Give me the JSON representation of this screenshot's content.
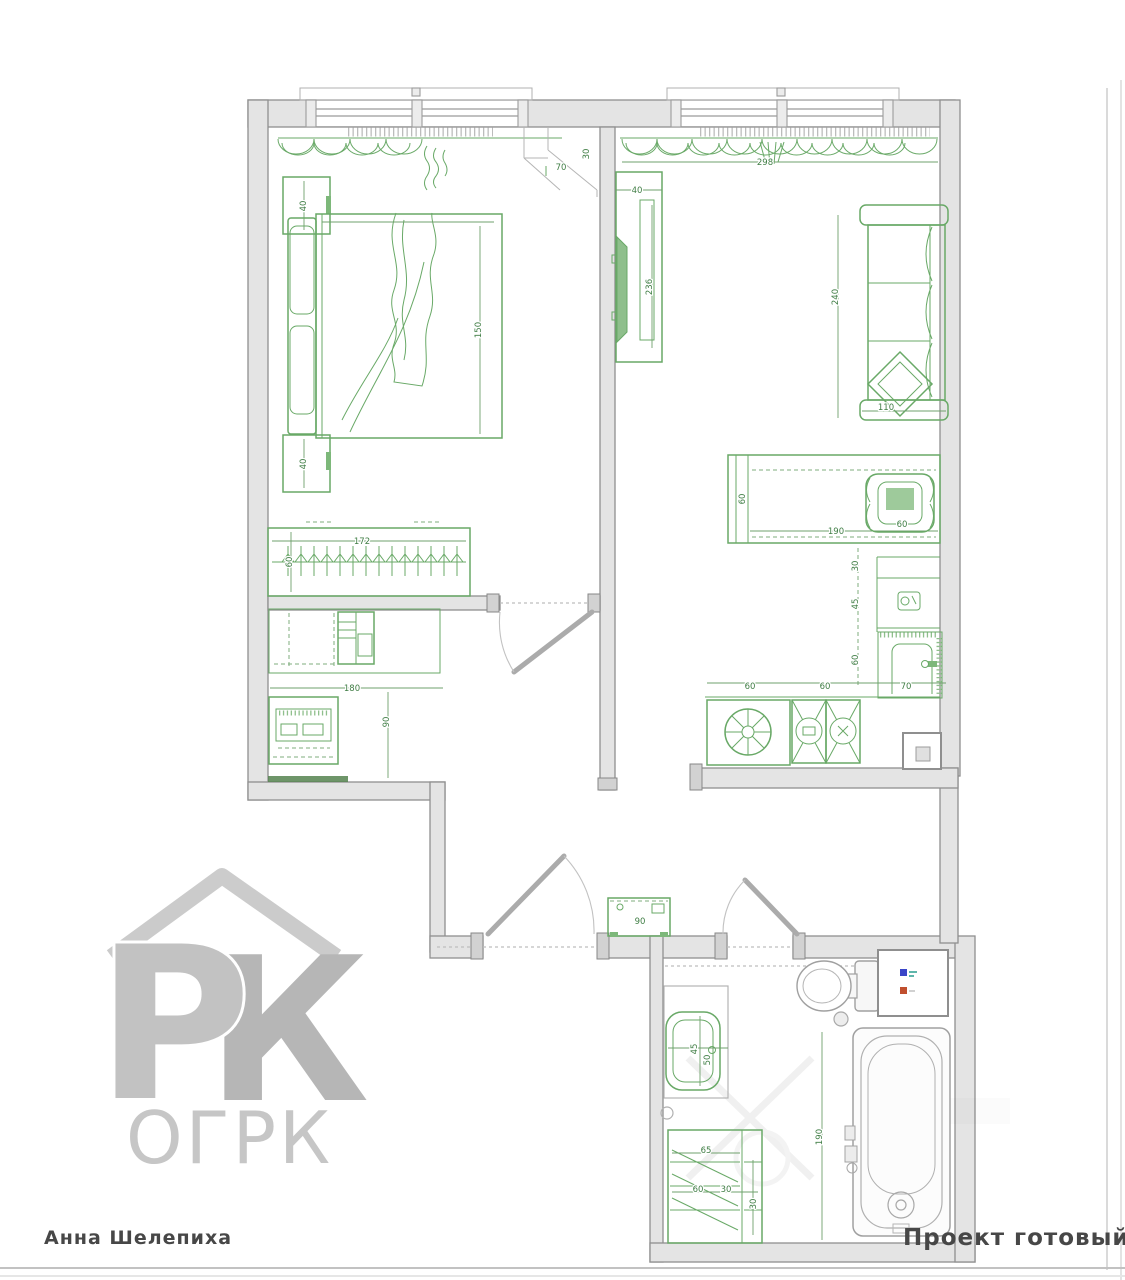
{
  "captions": {
    "author": "Анна Шелепиха",
    "status": "Проект готовый"
  },
  "watermark": {
    "letter_p": "Р",
    "letter_k": "К",
    "org": "ОГРК"
  },
  "colors": {
    "furniture_green": "#69a967",
    "dim_text_green": "#3f7d44",
    "wall_fill": "#e4e4e4",
    "wall_stroke": "#8f8f8f",
    "watermark_gray": "#c4c4c4",
    "caption_gray": "#474747",
    "cold_water_blue": "#3a46c8",
    "hot_water_red": "#c04f2e"
  },
  "dims": {
    "bedroom_nightstand_top": "40",
    "bedroom_corner_w": "70",
    "bedroom_corner_d": "30",
    "bed_length": "150",
    "wardrobe_width": "172",
    "wardrobe_depth": "60",
    "bedroom_nightstand_bottom": "40",
    "hall_width": "180",
    "hall_depth": "90",
    "living_width": "298",
    "tv_unit_depth": "40",
    "tv_unit_length": "236",
    "sofa_length": "240",
    "sofa_width": "110",
    "desk_depth": "60",
    "desk_length": "190",
    "chair_size": "60",
    "kitchen_side_1": "30",
    "kitchen_side_2": "45",
    "kitchen_side_3": "60",
    "kitchen_row_1": "60",
    "kitchen_row_2": "60",
    "kitchen_row_3": "70",
    "shoe_cabinet_width": "90",
    "sink_w": "45",
    "sink_d": "50",
    "bath_unit_top": "65",
    "bath_unit_a": "60",
    "bath_unit_b": "30",
    "bath_unit_side": "30",
    "tub_length": "190"
  }
}
